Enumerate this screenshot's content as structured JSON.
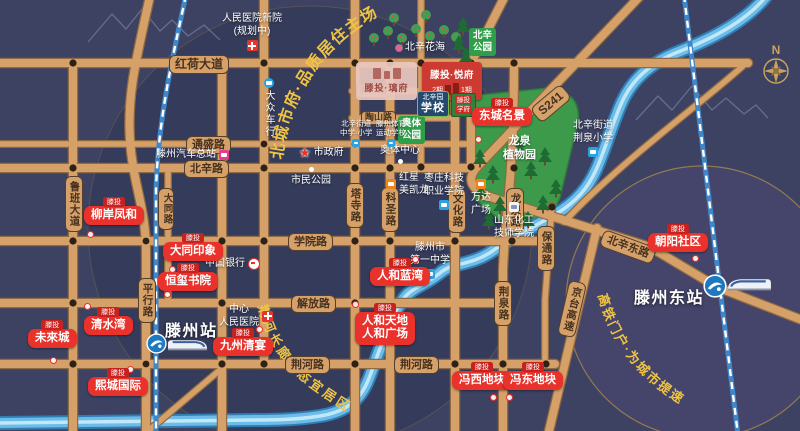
{
  "arcs": {
    "north_city": "北城市府·品质居住主场",
    "river": "荆河长廊生态宜居区",
    "hsr": "高铁门户·为城市提速"
  },
  "roads": {
    "honghe": "红荷大道",
    "tongsheng": "通盛路",
    "beixin": "北辛路",
    "xueyuan": "学院路",
    "jiefang": "解放路",
    "jinghe": "荆河路",
    "linzi": "林梓路",
    "taoshan": "陶山路",
    "luban": "鲁班大道",
    "datong": "大同路",
    "pingxing": "平行路",
    "tasi": "塔寺路",
    "kesheng": "科圣路",
    "wenhua": "文化路",
    "longquan": "龙泉路",
    "jingquan": "荆泉路",
    "baotong": "保通路",
    "jingtai": "京台高速",
    "s241": "S241",
    "beixindong": "北辛东路"
  },
  "stations": {
    "west": "滕州站",
    "east": "滕州东站"
  },
  "projects": {
    "liuan": {
      "tag": "滕投",
      "name": "柳岸凤和"
    },
    "datong": {
      "tag": "滕投",
      "name": "大同印象"
    },
    "hengxi": {
      "tag": "滕投",
      "name": "恒玺书院"
    },
    "weilai": {
      "tag": "滕投",
      "name": "未來城"
    },
    "qingshui": {
      "tag": "滕投",
      "name": "清水湾"
    },
    "xicheng": {
      "tag": "滕投",
      "name": "熙城国际"
    },
    "jiuzhou": {
      "tag": "滕投",
      "name": "九州清宴"
    },
    "dongcheng": {
      "tag": "滕投",
      "name": "东城名景"
    },
    "renhelan": {
      "tag": "滕投",
      "name": "人和蓝湾"
    },
    "renhetiandi": {
      "tag": "滕投",
      "l1": "人和天地",
      "l2": "人和广场"
    },
    "fengxi": {
      "tag": "滕投",
      "name": "冯西地块"
    },
    "fengdong": {
      "tag": "滕投",
      "name": "冯东地块"
    },
    "chaoyang": {
      "tag": "滕投",
      "name": "朝阳社区"
    }
  },
  "logos": {
    "yuefu": {
      "title": "滕投·悦府",
      "phase2": "2期",
      "phase1": "1期"
    },
    "lifu": {
      "title": "滕投·璃府"
    },
    "school": {
      "l1": "北辛园",
      "l2": "学校"
    },
    "xuefu": {
      "tag": "滕投",
      "name": "学府"
    }
  },
  "parks": {
    "aoti": {
      "l1": "奥体",
      "l2": "公园"
    },
    "beixin": {
      "l1": "北辛",
      "l2": "公园"
    },
    "flower": "北辛花海",
    "botanic": {
      "l1": "龙泉",
      "l2": "植物园"
    }
  },
  "pois": {
    "new_hospital": {
      "l1": "人民医院新院",
      "l2": "(规划中)"
    },
    "gov": "市政府",
    "citizen_park": "市民公园",
    "aoti_center": "奥体中心",
    "redstar": {
      "l1": "红星",
      "l2": "美凯龙"
    },
    "zz_college": {
      "l1": "枣庄科技",
      "l2": "职业学院"
    },
    "wanda": {
      "l1": "万达",
      "l2": "广场"
    },
    "chem": {
      "l1": "山东化工",
      "l2": "技师学院"
    },
    "no1": {
      "l1": "滕州市",
      "l2": "第一中学"
    },
    "jq_primary": {
      "l1": "北辛街道",
      "l2": "荆泉小学"
    },
    "bx_schools": {
      "l1": "北辛街道",
      "l2": "中学·小学"
    },
    "sports": {
      "l1": "滕州体育",
      "l2": "运动学校"
    },
    "dazhong": "大众车行",
    "bus": "滕州汽车总站",
    "bank": "中国银行",
    "c_hospital": {
      "l1": "中心",
      "l2": "人民医院"
    }
  },
  "compass": "N",
  "colors": {
    "road": "#d6a069",
    "marker_red": "#e8322b",
    "water": "#6cbbe8",
    "accent_gold": "#efc344"
  }
}
